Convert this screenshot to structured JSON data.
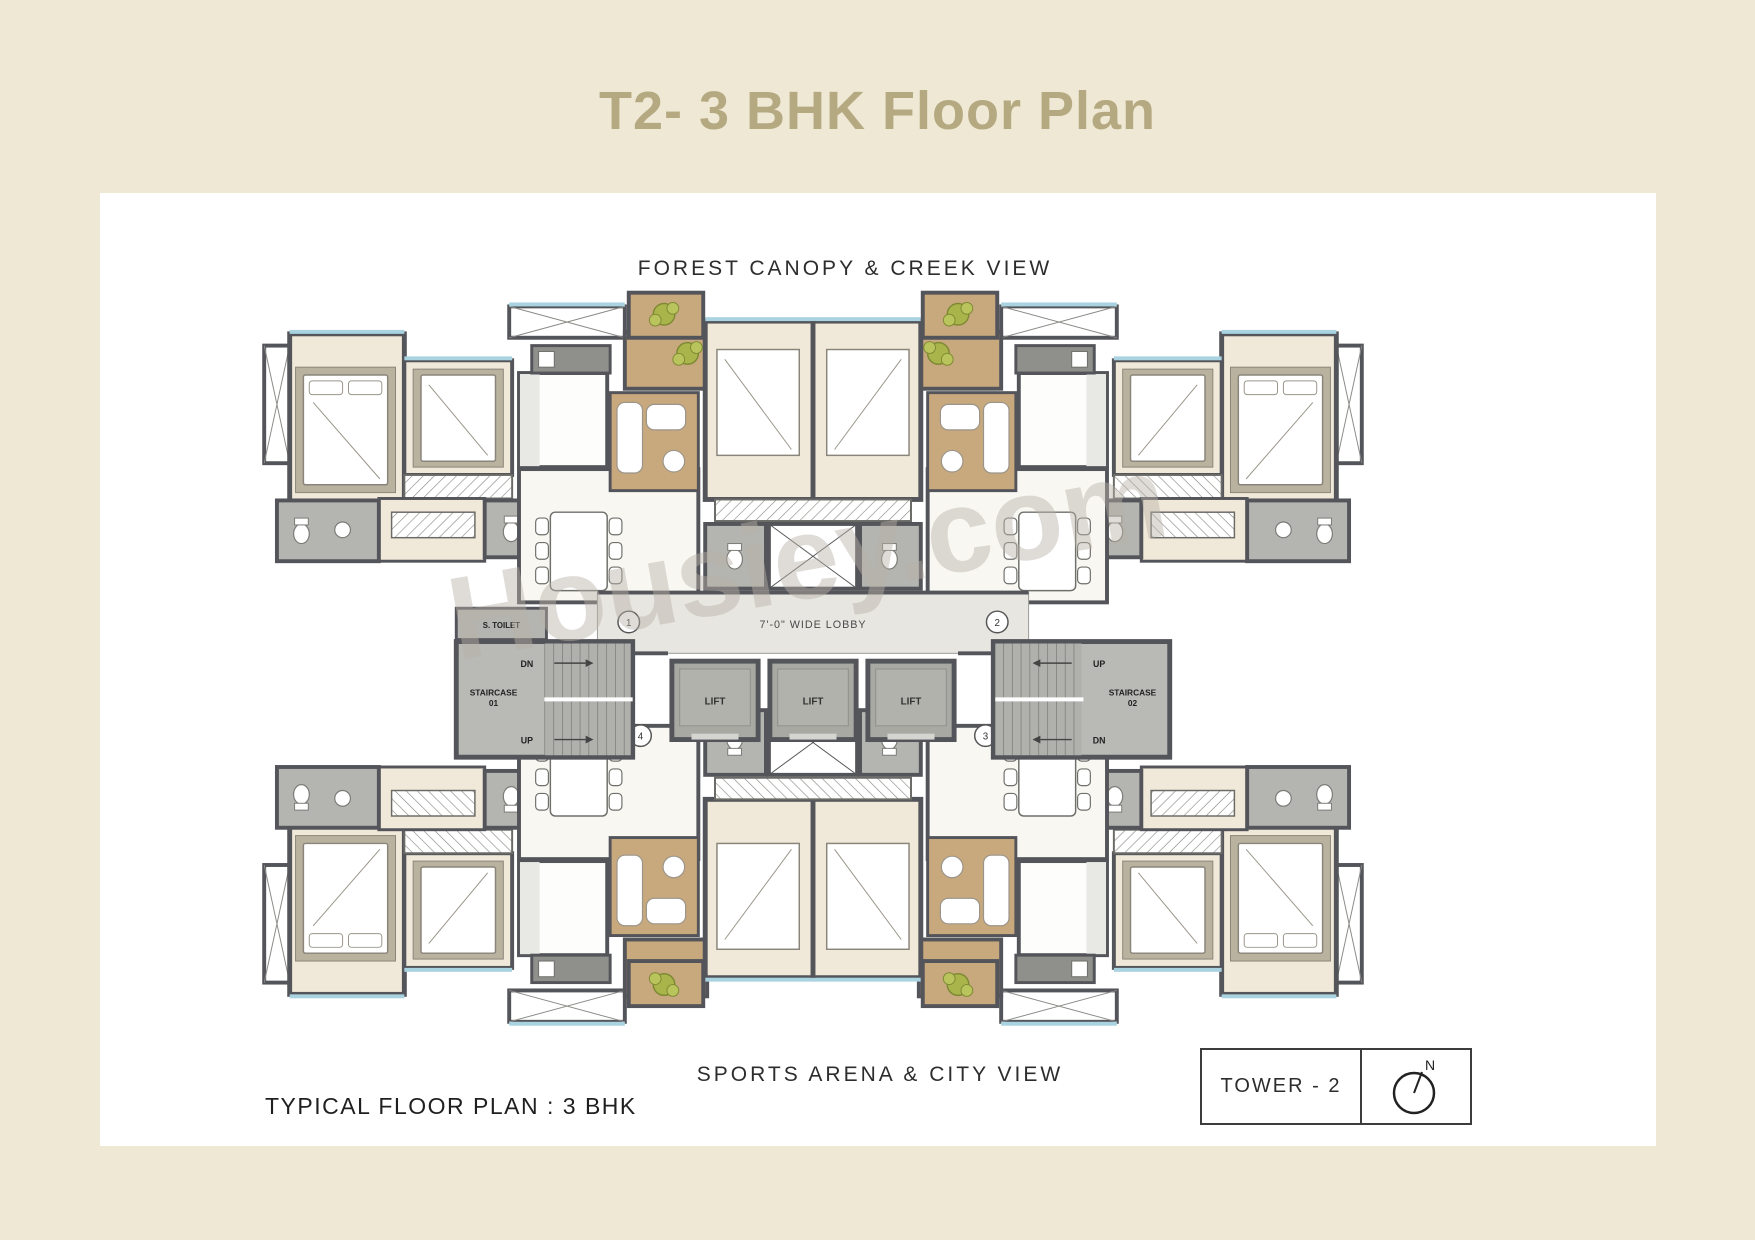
{
  "page": {
    "title": "T2- 3 BHK Floor Plan"
  },
  "plan": {
    "top_view_label": "FOREST CANOPY & CREEK VIEW",
    "bottom_view_label": "SPORTS ARENA & CITY VIEW",
    "caption": "TYPICAL FLOOR PLAN : 3 BHK",
    "watermark": "Housiey.com",
    "core": {
      "lobby_label": "7'-0\" WIDE LOBBY",
      "lift_labels": [
        "LIFT",
        "LIFT",
        "LIFT"
      ],
      "staircase_1": {
        "name": "STAIRCASE",
        "number": "01",
        "top_label": "DN",
        "bottom_label": "UP"
      },
      "staircase_2": {
        "name": "STAIRCASE",
        "number": "02",
        "top_label": "UP",
        "bottom_label": "DN"
      },
      "servant_toilet_label": "S. TOILET",
      "unit_markers": [
        "1",
        "2",
        "3",
        "4"
      ]
    },
    "tower_box": {
      "label": "TOWER - 2",
      "north": "N"
    }
  },
  "colors": {
    "page_bg": "#efe8d4",
    "title": "#b5a981",
    "wall": "#54555a",
    "floor_cream": "#f0e9d9",
    "marble": "#f8f7f2",
    "wood": "#c8a87d",
    "bath_gray": "#b4b4b0",
    "lobby_gray": "#e8e6e1",
    "lift_gray": "#a9a9a4",
    "sill_blue": "#a9d3e0",
    "plant_green": "#a9b54a"
  }
}
